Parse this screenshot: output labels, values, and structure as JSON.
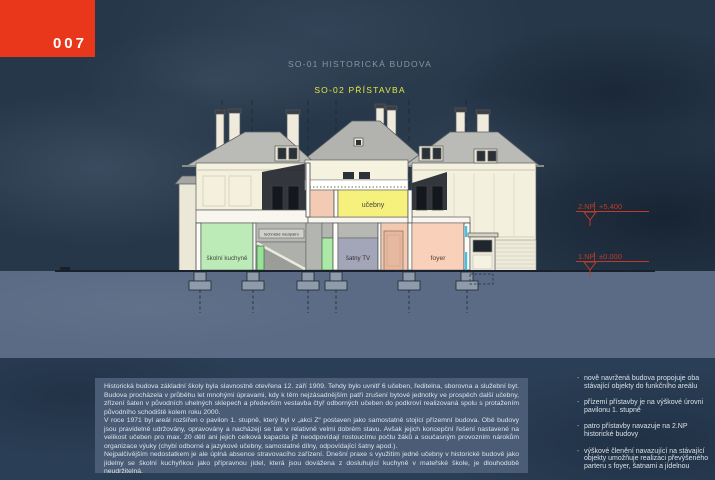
{
  "page": {
    "number": "007",
    "sky_color": "#263749",
    "ground_color": "#5b6b85",
    "footer_color": "#2a3e55",
    "accent_red": "#e8371b"
  },
  "titles": {
    "so01": "SO-01 HISTORICKÁ BUDOVA",
    "so01_color": "#8b949e",
    "so02": "SO-02 PŘÍSTAVBA",
    "so02_color": "#e3e83e"
  },
  "drawing": {
    "rooms": [
      {
        "label": "učebny",
        "color": "#f6f07d"
      },
      {
        "label": "školní kuchyně",
        "color": "#bdebb7"
      },
      {
        "label": "technické mezipatro",
        "color": "#cfcfcb"
      },
      {
        "label": "šatny TV",
        "color": "#a3a5b8"
      },
      {
        "label": "foyer",
        "color": "#f9d0ba"
      }
    ],
    "levels": [
      {
        "label": "2.NP",
        "value": "+5.400"
      },
      {
        "label": "1.NP",
        "value": "±0.000"
      }
    ],
    "level_color": "#bf3a28"
  },
  "description": {
    "paragraphs": [
      "Historická budova základní školy byla slavnostně otevřena 12. září 1909. Tehdy bylo uvnitř 6 učeben, ředitelna, sborovna a služební byt. Budova procházela v průběhu let mnohými úpravami, kdy k těm nejzásadnějším patří zrušení bytové jednotky ve prospěch další učebny, zřízení šaten v původních uhelných sklepech a především vestavba čtyř odborných učeben do podkroví realizovaná spolu s protažením původního schodiště kolem roku 2000.",
      "V roce 1971 byl areál rozšířen o pavilon 1. stupně, který byl v „akci Z“ postaven jako samostatně stojící přízemní budova. Obě budovy jsou pravidelně udržovány, opravovány a nacházejí se tak v relativně velmi dobrém stavu. Avšak jejich koncepční řešení nastavené na velikost učeben pro max. 20 dětí ani jejich celková kapacita již neodpovídají rostoucímu počtu žáků a současným provozním nárokům organizace výuky (chybí odborné a jazykové učebny, samostatné dílny, odpovídající šatny apod.).",
      "Nejpalčivějším nedostatkem je ale úplná absence stravovacího zařízení. Dnešní praxe s využitím jedné učebny v historické budově jako jídelny se školní kuchyňkou jako přípravnou jídel, která jsou dovážena z dosluhující kuchyně v mateřské škole, je dlouhodobě neudržitelná."
    ]
  },
  "bullets": {
    "items": [
      "nově navržená budova propojuje oba stávající objekty do funkčního areálu",
      "přízemí přístavby je na výškové úrovni pavilonu 1. stupně",
      "patro přístavby navazuje na 2.NP historické budovy",
      "výškové členění navazující na stávající objekty umožňuje realizaci převýšeného parteru s foyer, šatnami a jídelnou"
    ]
  }
}
